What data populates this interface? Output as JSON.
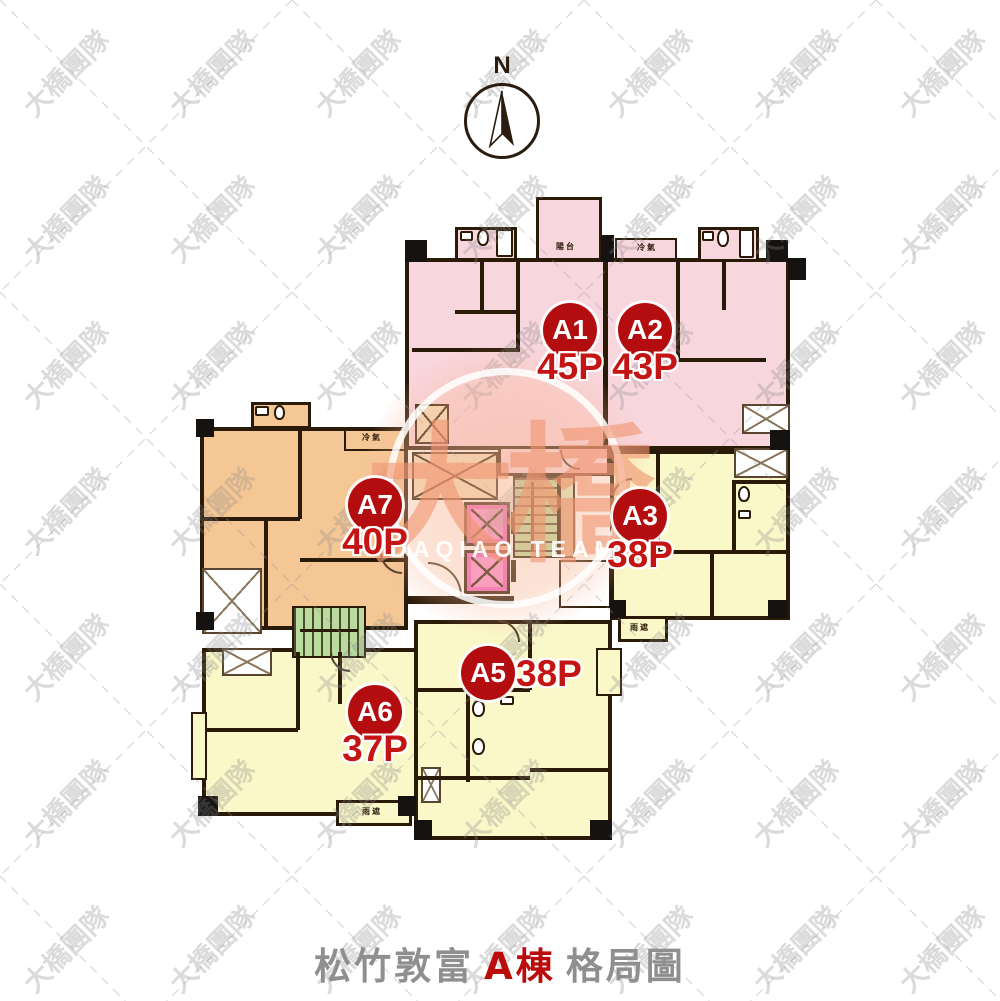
{
  "compass": {
    "label": "N"
  },
  "title": {
    "prefix": "松竹敦富",
    "building": "A棟",
    "suffix": "格局圖"
  },
  "watermark": {
    "tile_text": "大橋團隊",
    "center_main": "大橋",
    "center_sub": "DAQIAO TEAM"
  },
  "units": [
    {
      "id": "A1",
      "size": "45P"
    },
    {
      "id": "A2",
      "size": "43P"
    },
    {
      "id": "A3",
      "size": "38P"
    },
    {
      "id": "A5",
      "size": "38P"
    },
    {
      "id": "A6",
      "size": "37P"
    },
    {
      "id": "A7",
      "size": "40P"
    }
  ],
  "annotations": {
    "balcony": "陽台",
    "ac": "冷氣",
    "rain_cover": "雨遮"
  },
  "colors": {
    "unit_pink": "#f8d6de",
    "unit_orange": "#f5c795",
    "unit_yellow": "#faf7c9",
    "stair_green": "#b9dc9e",
    "elevator_magenta": "#f25fc0",
    "shaft_beige": "#f2e0bd",
    "badge_red": "#b40d0f",
    "size_text_red": "#c41414",
    "wall_dark": "#2a1a08",
    "title_gray": "#8f8f8f",
    "title_red": "#bb0b0b",
    "watermark_salmon": "#f09672"
  }
}
